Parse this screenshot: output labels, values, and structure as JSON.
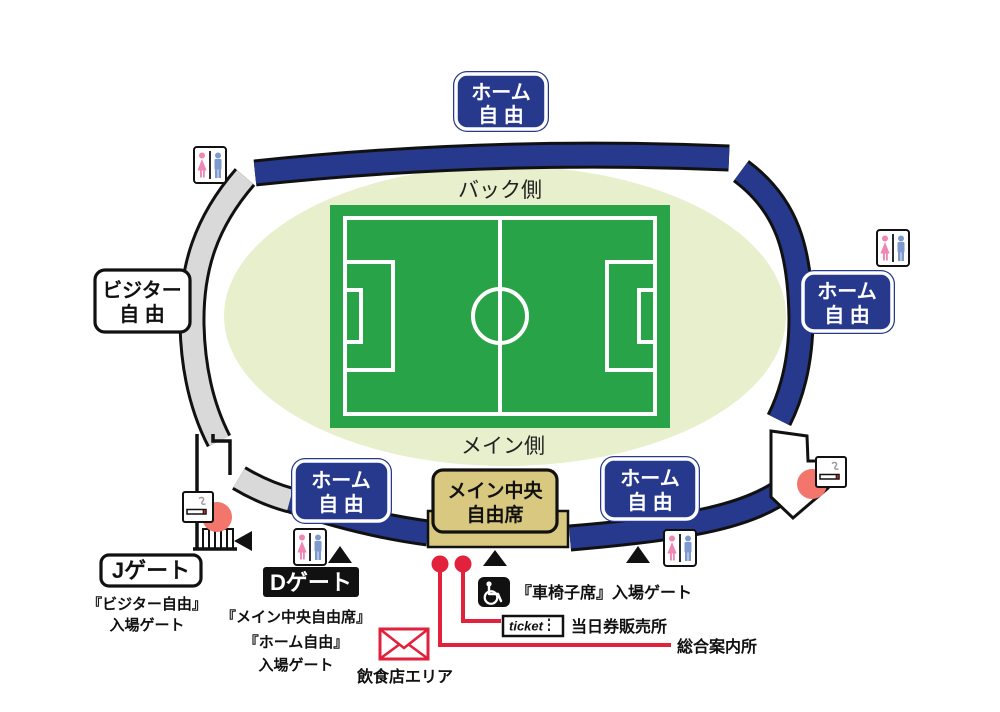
{
  "colors": {
    "stand_blue": "#27398C",
    "stand_gray": "#D9D9D9",
    "infield_oval": "#E7EFCC",
    "pitch_green": "#29A347",
    "main_center_tan": "#D9C87F",
    "highlight_salmon": "#F2766B",
    "annotation_red": "#E2213C",
    "toilet_pink": "#EE87B4",
    "toilet_blue": "#7D99CE"
  },
  "field": {
    "back_side": "バック側",
    "main_side": "メイン側"
  },
  "sections": {
    "home_free": {
      "line1": "ホーム",
      "line2": "自 由"
    },
    "visitor_free": {
      "line1": "ビジター",
      "line2": "自 由"
    },
    "main_center": {
      "line1": "メイン中央",
      "line2": "自由席"
    }
  },
  "gates": {
    "j_gate": {
      "label": "Jゲート",
      "desc_line1": "『ビジター自由』",
      "desc_line2": "入場ゲート"
    },
    "d_gate": {
      "label": "Dゲート",
      "desc_line1": "『メイン中央自由席』",
      "desc_line2": "『ホーム自由』",
      "desc_line3": "入場ゲート"
    },
    "wheelchair_gate": {
      "label": "『車椅子席』入場ゲート"
    }
  },
  "facilities": {
    "ticket_icon_label": "ticket",
    "ticket_office": "当日券販売所",
    "info_desk": "総合案内所",
    "food_area": "飲食店エリア"
  }
}
